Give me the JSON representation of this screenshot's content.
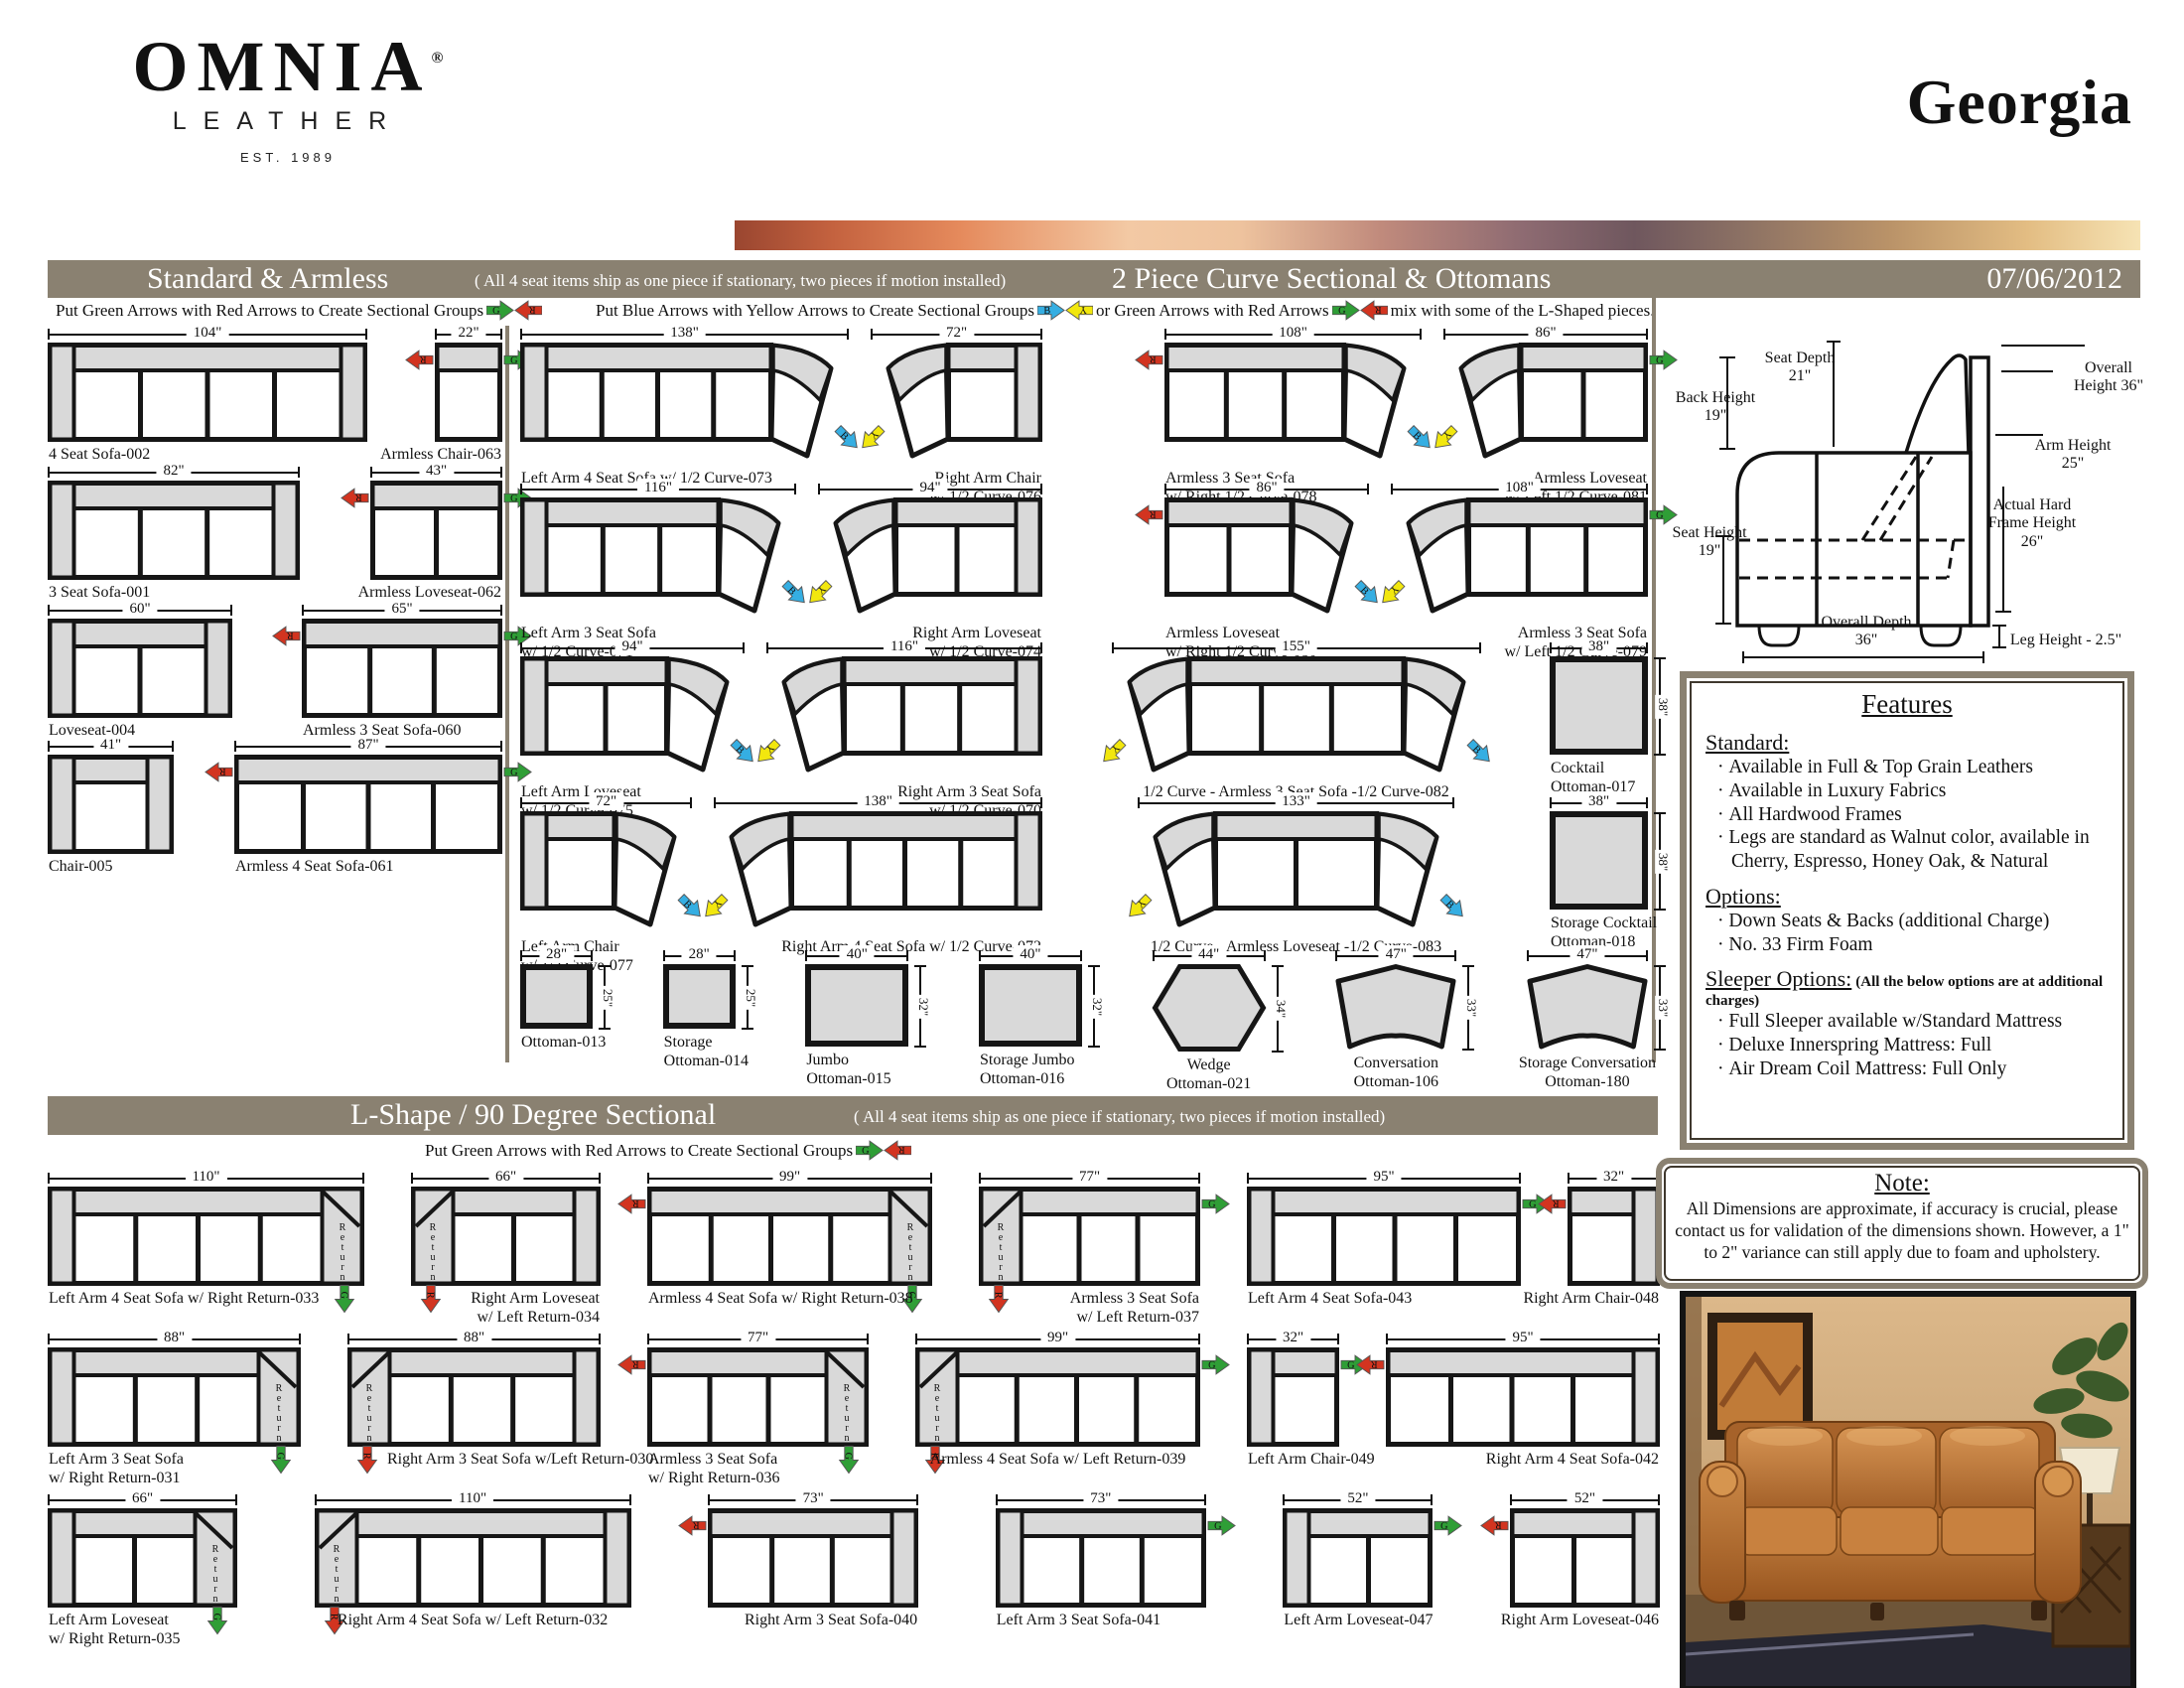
{
  "logo": {
    "brand": "OMNIA",
    "registered": "®",
    "sub": "LEATHER",
    "est": "EST. 1989"
  },
  "page_title": "Georgia",
  "date": "07/06/2012",
  "arrow_colors": {
    "G": "#2f9e36",
    "R": "#d23420",
    "B": "#35aee2",
    "Y": "#f2e70e"
  },
  "bar_color": "#8a8171",
  "sections": {
    "standard": {
      "title": "Standard & Armless",
      "subtitle": "( All 4 seat items ship as one piece if stationary, two pieces if motion installed)",
      "instruction": "Put Green Arrows with Red Arrows to Create Sectional Groups"
    },
    "curve": {
      "title": "2 Piece Curve Sectional & Ottomans",
      "instruction_blue": "Put Blue Arrows with Yellow Arrows to Create Sectional Groups",
      "instruction_or": "or Green Arrows with Red Arrows",
      "instruction_mix": "mix with some of the L-Shaped pieces."
    },
    "lshape": {
      "title": "L-Shape / 90 Degree Sectional",
      "subtitle": "( All 4 seat items ship as one piece if stationary, two pieces if motion installed)",
      "instruction": "Put Green Arrows with Red Arrows to Create Sectional Groups"
    }
  },
  "standard_rows": [
    [
      {
        "name": "4 Seat Sofa-002",
        "w": 104,
        "seats": 4,
        "arms": "both",
        "align": "left"
      },
      {
        "name": "Armless Chair-063",
        "w": 22,
        "seats": 1,
        "arms": "none",
        "arrows": {
          "left": "R",
          "right": "G"
        },
        "align": "right"
      }
    ],
    [
      {
        "name": "3 Seat Sofa-001",
        "w": 82,
        "seats": 3,
        "arms": "both",
        "align": "left"
      },
      {
        "name": "Armless Loveseat-062",
        "w": 43,
        "seats": 2,
        "arms": "none",
        "arrows": {
          "left": "R",
          "right": "G"
        },
        "align": "right"
      }
    ],
    [
      {
        "name": "Loveseat-004",
        "w": 60,
        "seats": 2,
        "arms": "both",
        "align": "left"
      },
      {
        "name": "Armless 3 Seat Sofa-060",
        "w": 65,
        "seats": 3,
        "arms": "none",
        "arrows": {
          "left": "R",
          "right": "G"
        },
        "align": "left"
      }
    ],
    [
      {
        "name": "Chair-005",
        "w": 41,
        "seats": 1,
        "arms": "both",
        "align": "left"
      },
      {
        "name": "Armless 4 Seat Sofa-061",
        "w": 87,
        "seats": 4,
        "arms": "none",
        "arrows": {
          "left": "R",
          "right": "G"
        },
        "align": "left"
      }
    ]
  ],
  "curve_pair_rows": [
    [
      [
        {
          "name": "Left Arm 4 Seat Sofa w/ 1/2 Curve-073",
          "w": 138,
          "seats": 4,
          "arms": "left",
          "curve": "right",
          "tipR": "B",
          "align": "left"
        },
        {
          "name": "Right Arm Chair\nw/ 1/2 Curve-076",
          "w": 72,
          "seats": 1,
          "arms": "right",
          "curve": "left",
          "tipL": "Y",
          "align": "right"
        }
      ],
      [
        {
          "name": "Armless 3 Seat Sofa\nw/ Right 1/2 Curve-078",
          "w": 108,
          "seats": 3,
          "arms": "none",
          "curve": "right",
          "tipR": "B",
          "arrows": {
            "left": "R"
          },
          "align": "left"
        },
        {
          "name": "Armless Loveseat\nw/ Left 1/2 Curve-081",
          "w": 86,
          "seats": 2,
          "arms": "none",
          "curve": "left",
          "tipL": "Y",
          "arrows": {
            "right": "G"
          },
          "align": "right"
        }
      ]
    ],
    [
      [
        {
          "name": "Left Arm 3 Seat Sofa\nw/ 1/2 Curve-071",
          "w": 116,
          "seats": 3,
          "arms": "left",
          "curve": "right",
          "tipR": "B",
          "align": "left"
        },
        {
          "name": "Right Arm Loveseat\nw/ 1/2 Curve-074",
          "w": 94,
          "seats": 2,
          "arms": "right",
          "curve": "left",
          "tipL": "Y",
          "align": "right"
        }
      ],
      [
        {
          "name": "Armless Loveseat\nw/ Right 1/2 Curve-080",
          "w": 86,
          "seats": 2,
          "arms": "none",
          "curve": "right",
          "tipR": "B",
          "arrows": {
            "left": "R"
          },
          "align": "left"
        },
        {
          "name": "Armless 3 Seat Sofa\nw/ Left 1/2 Curve-079",
          "w": 108,
          "seats": 3,
          "arms": "none",
          "curve": "left",
          "tipL": "Y",
          "arrows": {
            "right": "G"
          },
          "align": "right"
        }
      ]
    ]
  ],
  "curve_combo_rows": [
    {
      "pair": [
        {
          "name": "Left Arm Loveseat\nw/ 1/2 Curve-075",
          "w": 94,
          "seats": 2,
          "arms": "left",
          "curve": "right",
          "tipR": "B",
          "align": "left"
        },
        {
          "name": "Right Arm 3 Seat Sofa\nw/ 1/2 Curve-070",
          "w": 116,
          "seats": 3,
          "arms": "right",
          "curve": "left",
          "tipL": "Y",
          "align": "right"
        }
      ],
      "combo": {
        "name": "1/2 Curve - Armless 3 Seat Sofa -1/2 Curve-082",
        "w": 155,
        "seats": 3,
        "arms": "none",
        "curve": "both",
        "tipL": "Y",
        "tipR": "B",
        "align": "center"
      },
      "ottoman": {
        "name": "Cocktail\nOttoman-017",
        "w": 38,
        "h": 38,
        "shape": "rect",
        "align": "left"
      }
    },
    {
      "pair": [
        {
          "name": "Left Arm Chair\nw/ 1/2 Curve-077",
          "w": 72,
          "seats": 1,
          "arms": "left",
          "curve": "right",
          "tipR": "B",
          "align": "left"
        },
        {
          "name": "Right Arm 4 Seat Sofa w/ 1/2 Curve-072",
          "w": 138,
          "seats": 4,
          "arms": "right",
          "curve": "left",
          "tipL": "Y",
          "align": "right"
        }
      ],
      "combo": {
        "name": "1/2 Curve - Armless Loveseat -1/2 Curve-083",
        "w": 133,
        "seats": 2,
        "arms": "none",
        "curve": "both",
        "tipL": "Y",
        "tipR": "B",
        "align": "center"
      },
      "ottoman": {
        "name": "Storage Cocktail\nOttoman-018",
        "w": 38,
        "h": 38,
        "shape": "rect",
        "align": "left"
      }
    }
  ],
  "ottoman_row": [
    {
      "name": "Ottoman-013",
      "w": 28,
      "h": 25,
      "shape": "rect",
      "align": "left"
    },
    {
      "name": "Storage\nOttoman-014",
      "w": 28,
      "h": 25,
      "shape": "rect",
      "align": "left"
    },
    {
      "name": "Jumbo\nOttoman-015",
      "w": 40,
      "h": 32,
      "shape": "rect",
      "align": "left"
    },
    {
      "name": "Storage Jumbo\nOttoman-016",
      "w": 40,
      "h": 32,
      "shape": "rect",
      "align": "left"
    },
    {
      "name": "Wedge\nOttoman-021",
      "w": 44,
      "h": 34,
      "shape": "hex",
      "align": "center"
    },
    {
      "name": "Conversation\nOttoman-106",
      "w": 47,
      "h": 33,
      "shape": "conv",
      "align": "center"
    },
    {
      "name": "Storage Conversation\nOttoman-180",
      "w": 47,
      "h": 33,
      "shape": "conv",
      "align": "center"
    }
  ],
  "lshape_rows": [
    [
      {
        "name": "Left Arm 4 Seat Sofa w/ Right Return-033",
        "w": 110,
        "seats": 4,
        "arms": "left",
        "ret": "right",
        "retArrow": "G",
        "align": "left"
      },
      {
        "name": "Right Arm Loveseat\nw/ Left Return-034",
        "w": 66,
        "seats": 2,
        "arms": "right",
        "ret": "left",
        "retArrow": "R",
        "align": "right"
      },
      {
        "name": "Armless 4 Seat Sofa w/ Right Return-038",
        "w": 99,
        "seats": 4,
        "arms": "none",
        "ret": "right",
        "retArrow": "G",
        "arrows": {
          "left": "R"
        },
        "align": "left"
      },
      {
        "name": "Armless 3 Seat Sofa\nw/ Left Return-037",
        "w": 77,
        "seats": 3,
        "arms": "none",
        "ret": "left",
        "retArrow": "R",
        "arrows": {
          "right": "G"
        },
        "align": "right"
      },
      {
        "name": "Left Arm 4 Seat Sofa-043",
        "w": 95,
        "seats": 4,
        "arms": "left",
        "arrows": {
          "right": "G"
        },
        "align": "left"
      },
      {
        "name": "Right Arm Chair-048",
        "w": 32,
        "seats": 1,
        "arms": "right",
        "arrows": {
          "left": "R"
        },
        "align": "right"
      }
    ],
    [
      {
        "name": "Left Arm 3 Seat Sofa\nw/ Right Return-031",
        "w": 88,
        "seats": 3,
        "arms": "left",
        "ret": "right",
        "retArrow": "G",
        "align": "left"
      },
      {
        "name": "Right Arm 3 Seat Sofa w/Left Return-030",
        "w": 88,
        "seats": 3,
        "arms": "right",
        "ret": "left",
        "retArrow": "R",
        "align": "pad"
      },
      {
        "name": "Armless 3 Seat Sofa\nw/ Right Return-036",
        "w": 77,
        "seats": 3,
        "arms": "none",
        "ret": "right",
        "retArrow": "G",
        "arrows": {
          "left": "R"
        },
        "align": "left"
      },
      {
        "name": "Armless 4 Seat Sofa w/ Left Return-039",
        "w": 99,
        "seats": 4,
        "arms": "none",
        "ret": "left",
        "retArrow": "R",
        "arrows": {
          "right": "G"
        },
        "align": "center"
      },
      {
        "name": "Left Arm Chair-049",
        "w": 32,
        "seats": 1,
        "arms": "left",
        "arrows": {
          "right": "G"
        },
        "align": "left"
      },
      {
        "name": "Right Arm 4 Seat Sofa-042",
        "w": 95,
        "seats": 4,
        "arms": "right",
        "arrows": {
          "left": "R"
        },
        "align": "right"
      }
    ],
    [
      {
        "name": "Left Arm Loveseat\nw/ Right Return-035",
        "w": 66,
        "seats": 2,
        "arms": "left",
        "ret": "right",
        "retArrow": "G",
        "align": "left"
      },
      {
        "name": "Right Arm 4 Seat Sofa w/ Left Return-032",
        "w": 110,
        "seats": 4,
        "arms": "right",
        "ret": "left",
        "retArrow": "R",
        "align": "center"
      },
      {
        "name": "Right Arm 3 Seat Sofa-040",
        "w": 73,
        "seats": 3,
        "arms": "right",
        "arrows": {
          "left": "R"
        },
        "align": "right"
      },
      {
        "name": "Left Arm 3 Seat Sofa-041",
        "w": 73,
        "seats": 3,
        "arms": "left",
        "arrows": {
          "right": "G"
        },
        "align": "left"
      },
      {
        "name": "Left Arm Loveseat-047",
        "w": 52,
        "seats": 2,
        "arms": "left",
        "arrows": {
          "right": "G"
        },
        "align": "left"
      },
      {
        "name": "Right Arm Loveseat-046",
        "w": 52,
        "seats": 2,
        "arms": "right",
        "arrows": {
          "left": "R"
        },
        "align": "right"
      }
    ]
  ],
  "side_diagram": {
    "back_height": "Back Height 19\"",
    "seat_depth": "Seat Depth 21\"",
    "overall_height": "Overall Height 36\"",
    "arm_height": "Arm Height 25\"",
    "frame_height": "Actual Hard Frame Height 26\"",
    "seat_height": "Seat Height 19\"",
    "overall_depth": "Overall Depth 36\"",
    "leg_height": "Leg Height - 2.5\""
  },
  "features": {
    "title": "Features",
    "groups": [
      {
        "heading": "Standard:",
        "note": "",
        "items": [
          "Available in Full & Top Grain Leathers",
          "Available in Luxury Fabrics",
          "All Hardwood Frames",
          "Legs are standard as Walnut color, available in Cherry, Espresso, Honey Oak, & Natural"
        ]
      },
      {
        "heading": "Options:",
        "note": "",
        "items": [
          "Down Seats & Backs (additional Charge)",
          "No. 33 Firm Foam"
        ]
      },
      {
        "heading": "Sleeper Options:",
        "note": "(All the below options are at additional charges)",
        "items": [
          "Full Sleeper available w/Standard Mattress",
          "Deluxe Innerspring Mattress: Full",
          "Air Dream Coil Mattress: Full Only"
        ]
      }
    ]
  },
  "note": {
    "title": "Note:",
    "text": "All Dimensions are approximate, if accuracy is crucial, please contact us for validation of the dimensions shown. However, a 1\" to 2\" variance can still apply due to foam and upholstery."
  }
}
